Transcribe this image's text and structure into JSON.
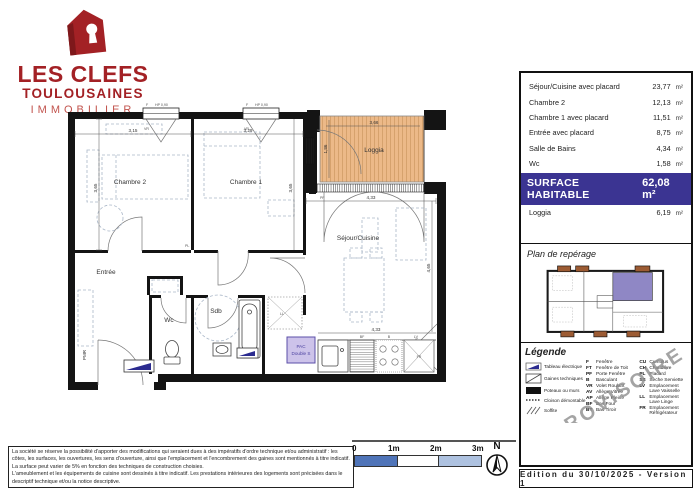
{
  "brand": {
    "line1": "LES CLEFS",
    "line2": "TOULOUSAINES",
    "line3": "IMMOBILIER"
  },
  "areas": {
    "rows": [
      {
        "label": "Séjour/Cuisine avec placard",
        "value": "23,77",
        "unit": "m²"
      },
      {
        "label": "Chambre 2",
        "value": "12,13",
        "unit": "m²"
      },
      {
        "label": "Chambre 1 avec placard",
        "value": "11,51",
        "unit": "m²"
      },
      {
        "label": "Entrée avec placard",
        "value": "8,75",
        "unit": "m²"
      },
      {
        "label": "Salle de Bains",
        "value": "4,34",
        "unit": "m²"
      },
      {
        "label": "Wc",
        "value": "1,58",
        "unit": "m²"
      }
    ],
    "total_label": "SURFACE HABITABLE",
    "total_value": "62,08 m²",
    "loggia": {
      "label": "Loggia",
      "value": "6,19",
      "unit": "m²"
    }
  },
  "reperage": {
    "title": "Plan de repérage"
  },
  "legend": {
    "title": "Légende",
    "watermark": "PROVISOIRE",
    "symbols": [
      "Tableau électrique",
      "Gaines techniques",
      "Poteaux ou murs",
      "Cloison démontable",
      "Soffite"
    ],
    "abbr_left": [
      {
        "k": "F",
        "v": "Fenêtre"
      },
      {
        "k": "FT",
        "v": "Fenêtre de Toit"
      },
      {
        "k": "PF",
        "v": "Porte Fenêtre"
      },
      {
        "k": "B",
        "v": "Basculant"
      },
      {
        "k": "VR",
        "v": "Volet Roulant"
      },
      {
        "k": "AV",
        "v": "Allège Vitrée"
      },
      {
        "k": "AP",
        "v": "Allège Pleine"
      },
      {
        "k": "BF",
        "v": "Bas Four"
      },
      {
        "k": "BT",
        "v": "Bas Tiroir"
      }
    ],
    "abbr_right": [
      {
        "k": "CU",
        "v": "Cumulus"
      },
      {
        "k": "CH",
        "v": "Chaudière"
      },
      {
        "k": "PL",
        "v": "Placard"
      },
      {
        "k": "SS",
        "v": "Sèche Serviette"
      },
      {
        "k": "LV",
        "v": "Emplacement Lave Vaisselle"
      },
      {
        "k": "LL",
        "v": "Emplacement Lave Linge"
      },
      {
        "k": "FR",
        "v": "Emplacement Réfrigérateur"
      }
    ]
  },
  "plan": {
    "rooms": {
      "chambre2": "Chambre 2",
      "chambre1": "Chambre 1",
      "loggia": "Loggia",
      "sejour": "Séjour/Cuisine",
      "entree": "Entrée",
      "wc": "Wc",
      "sdb": "Sdb",
      "pmr": "PMR"
    },
    "dims": {
      "chambre2_w": "3,15",
      "chambre1_w": "3,29",
      "chambre2_h": "3,65",
      "chambre1_h": "3,65",
      "sejour_w_top": "4,33",
      "sejour_h": "4,65",
      "sejour_w_bottom": "4,33",
      "loggia_w": "3,66",
      "loggia_h": "1,86"
    },
    "tags": {
      "f1": "F",
      "f2": "F",
      "hp1": "HP 0,90",
      "hp2": "HP 0,90",
      "vr1": "VR",
      "vr2": "VR",
      "vr3": "VR",
      "pf": "PF",
      "pl": "PL",
      "ll": "LL",
      "fr": "FR",
      "k1": "BF",
      "k2": "B",
      "k3": "LV",
      "pac1": "PAC",
      "pac2": "Double S"
    }
  },
  "scale": {
    "ticks": [
      "0",
      "1m",
      "2m",
      "3m"
    ]
  },
  "compass": {
    "label": "N"
  },
  "footer": {
    "edition": "Edition du 30/10/2025 - Version 1"
  },
  "disclaimer": {
    "p1": "La société se réserve la possibilité d'apporter des modifications qui seraient dues à des impératifs d'ordre technique et/ou administratif : les côtes, les surfaces, les ouvertures, les sens d'ouverture, ainsi que l'emplacement et l'encombrement des gaines sont mentionnés à titre indicatif. La surface peut varier de 5% en fonction des techniques de construction choisies.",
    "p2": "L'ameublement et les équipements de cuisine sont dessinés à titre indicatif. Les prestations intérieures des logements sont précisées dans le descriptif technique et/ou la notice descriptive."
  },
  "colors": {
    "brand_red": "#a32125",
    "banner_indigo": "#3b3492",
    "loggia_orange": "#ecb988",
    "unit_highlight_purple": "#8f87c5",
    "balcony_brown": "#9c5b33",
    "scale_blue": "#4f74b8",
    "scale_light_blue": "#aec2e0",
    "pac_purple": "#cdc3ea"
  }
}
